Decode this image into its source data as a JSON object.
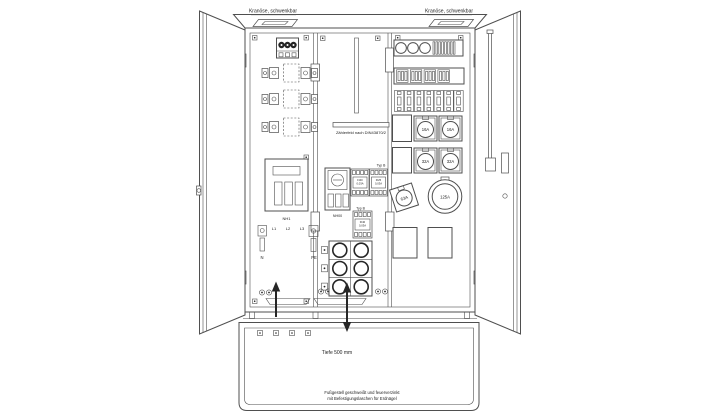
{
  "colors": {
    "background": "#ffffff",
    "line": "#4f4f4f",
    "dark": "#262626",
    "text": "#1c1c1c"
  },
  "top": {
    "crane_left": "Kranöse, schwenkbar",
    "crane_right": "Kranöse, schwenkbar"
  },
  "meter": {
    "label": "Zählerfeld nach DIN43870/2"
  },
  "switches": {
    "nh1": "NH1",
    "nh00": "NH00"
  },
  "phases": {
    "l1": "L1",
    "l2": "L2",
    "l3": "L3",
    "n": "N",
    "pe": "PE"
  },
  "rcds": {
    "upper_label": "Typ B",
    "lower_label": "Typ B",
    "upper_left_line1": "FI40",
    "upper_left_line2": "0,03A",
    "upper_right_line1": "FI25",
    "upper_right_line2": "0,03A",
    "lower_line1": "FI40",
    "lower_line2": "0,03A"
  },
  "sockets": {
    "s16_1": "16A",
    "s16_2": "16A",
    "s32_1": "32A",
    "s32_2": "32A",
    "s63": "63A",
    "s125": "125A"
  },
  "base": {
    "depth": "Tiefe 500 mm",
    "footer_line1": "Fußgestell geschweißt und feuerverzinkt",
    "footer_line2": "mit Befestigungslaschen für Erdnägel"
  }
}
